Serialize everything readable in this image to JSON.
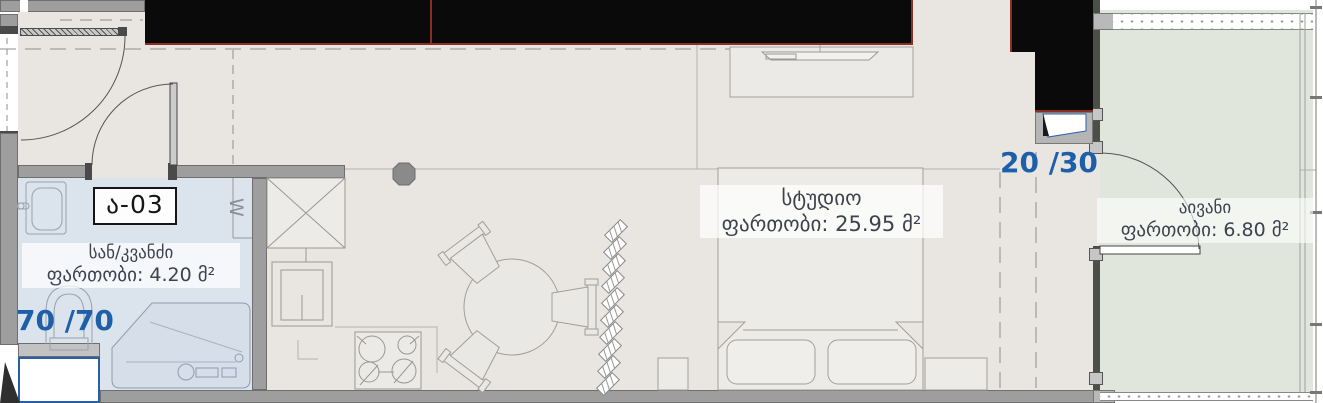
{
  "unit_label": "ა-03",
  "rooms": {
    "bathroom": {
      "name": "სან/კვანძი",
      "area": "ფართობი: 4.20 მ²",
      "area_value": "4.20"
    },
    "studio": {
      "name": "სტუდიო",
      "area": "ფართობი: 25.95 მ²",
      "area_value": "25.95"
    },
    "balcony": {
      "name": "აივანი",
      "area": "ფართობი: 6.80 მ²",
      "area_value": "6.80"
    }
  },
  "dimensions": {
    "bathroom_shaft": "70 /70",
    "balcony_shaft": "20 /30"
  },
  "symbols": {
    "washing_machine": "W"
  },
  "colors": {
    "floor": "#e9e6e2",
    "bathroom_floor": "#dbe3ec",
    "balcony_floor": "#e1e6dd",
    "wall_gray": "#9e9e9e",
    "balcony_wall": "#4b5046",
    "poche_black": "#0a0a0a",
    "accent_red": "#8a2f24",
    "dimension_blue": "#1d5fa8",
    "label_text": "#3d424c",
    "shaft_border_blue": "#2b5ea8"
  }
}
